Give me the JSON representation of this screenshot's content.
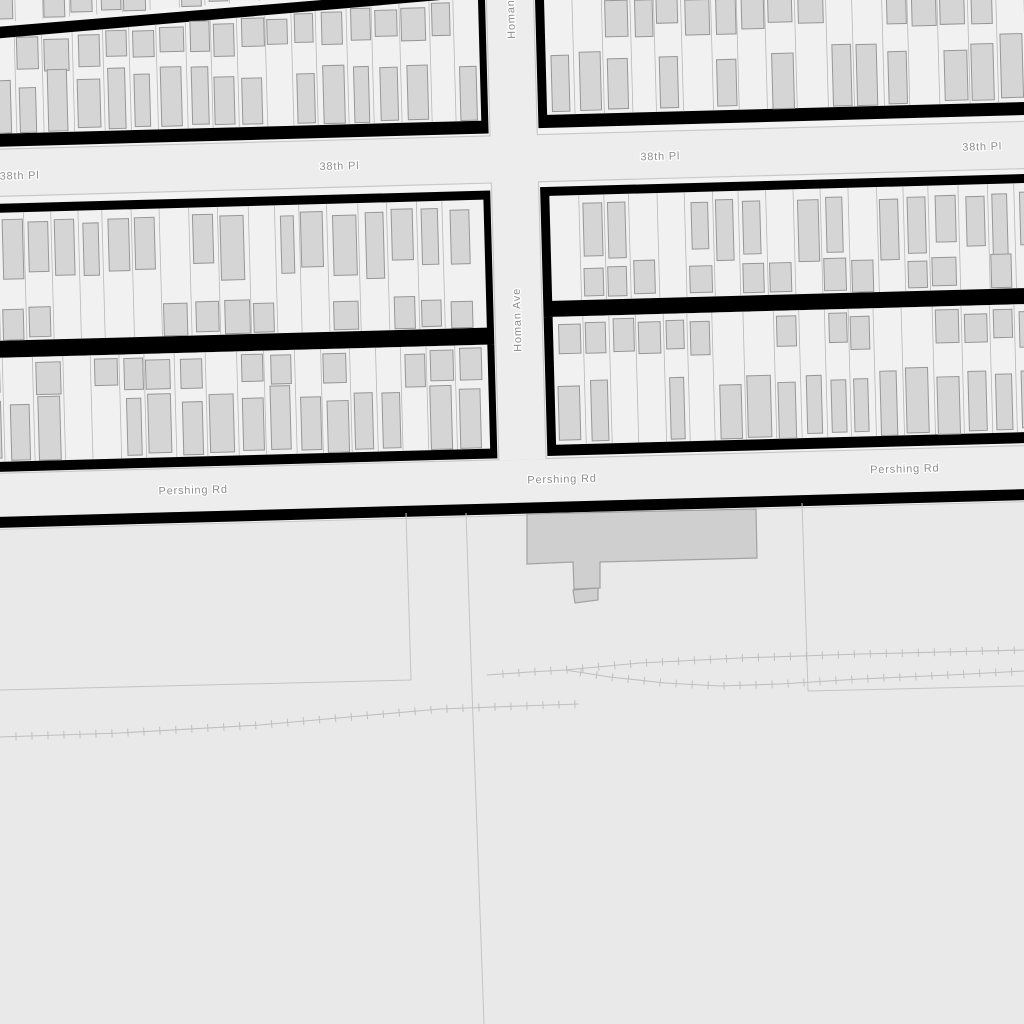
{
  "map_title": "Map: 38th Pl, Homan Ave, Pershing Rd",
  "colors": {
    "open_area": "#e9e9e9",
    "top_area": "#f3f3f3",
    "street_fill": "#ededed",
    "street_casing": "#c9c9c9",
    "block_border": "#000000",
    "parcel_fill": "#f1f1f1",
    "lot_line": "#b8b8b8",
    "building_fill": "#d5d5d5",
    "building_stroke": "#979797",
    "big_building_fill": "#cfcfcf",
    "big_building_stroke": "#a2a2a2",
    "label_color": "#8c8c8c",
    "label_halo": "#ffffff",
    "line_color": "#c4c4c4",
    "rail_color": "#bfbfbf"
  },
  "rotation_deg": -1.55,
  "rotation_center": [
    512,
    480
  ],
  "streets": [
    {
      "id": "street-38th-pl",
      "name": "38th Pl",
      "rect": [
        -120,
        136,
        1400,
        46
      ]
    },
    {
      "id": "street-pershing-rd",
      "name": "Pershing Rd",
      "rect": [
        -120,
        460,
        1400,
        43
      ]
    },
    {
      "id": "street-homan-ave",
      "name": "Homan Ave",
      "rect": [
        500,
        -120,
        46,
        580
      ]
    }
  ],
  "labels": [
    {
      "street": "street-38th-pl",
      "text": "38th Pl",
      "x": 28,
      "y": 166,
      "vertical": false
    },
    {
      "street": "street-38th-pl",
      "text": "38th Pl",
      "x": 348,
      "y": 165,
      "vertical": false
    },
    {
      "street": "street-38th-pl",
      "text": "38th Pl",
      "x": 669,
      "y": 164,
      "vertical": false
    },
    {
      "street": "street-38th-pl",
      "text": "38th Pl",
      "x": 991,
      "y": 163,
      "vertical": false
    },
    {
      "street": "street-pershing-rd",
      "text": "Pershing Rd",
      "x": 193,
      "y": 485,
      "vertical": false
    },
    {
      "street": "street-pershing-rd",
      "text": "Pershing Rd",
      "x": 562,
      "y": 484,
      "vertical": false
    },
    {
      "street": "street-pershing-rd",
      "text": "Pershing Rd",
      "x": 905,
      "y": 483,
      "vertical": false
    },
    {
      "street": "street-homan-ave",
      "text": "Homan Ave",
      "x": 525,
      "y": 352,
      "vertical": true
    },
    {
      "street": "street-homan-ave",
      "text": "Homan Ave",
      "x": 527,
      "y": 39,
      "vertical": true
    }
  ],
  "blocks": [
    {
      "id": "block-nw-sliver",
      "seed": 7,
      "lotW": 27.5,
      "parcels": {
        "x": -80,
        "w": 571,
        "poly": [
          [
            -80,
            -50
          ],
          [
            491,
            -50
          ],
          [
            491,
            -18
          ],
          [
            -80,
            14
          ]
        ],
        "y": -50,
        "botDiag": {
          "p1": [
            -80,
            14
          ],
          "p2": [
            491,
            -18
          ]
        }
      },
      "rows": [
        {
          "kind": "garage",
          "edge": "bottom",
          "hMin": 24,
          "hMax": 30,
          "prob": 0.7,
          "xMax": 300
        }
      ]
    },
    {
      "id": "block-nw",
      "seed": 21,
      "lotW": 27.5,
      "black": {
        "poly": [
          [
            -80,
            18
          ],
          [
            498,
            -14
          ],
          [
            498,
            133
          ],
          [
            -80,
            133
          ]
        ]
      },
      "parcels": {
        "x": -80,
        "w": 571,
        "poly": [
          [
            -80,
            30
          ],
          [
            491,
            -4
          ],
          [
            491,
            120
          ],
          [
            -80,
            120
          ]
        ],
        "topDiag": {
          "p1": [
            -80,
            30
          ],
          "p2": [
            491,
            -4
          ]
        },
        "y2": 120
      },
      "rows": [
        {
          "kind": "garage",
          "edge": "top",
          "hMin": 24,
          "hMax": 34,
          "prob": 0.75
        },
        {
          "kind": "house",
          "edge": "bottom",
          "y": 120,
          "hMin": 44,
          "hMax": 62,
          "prob": 0.9
        }
      ]
    },
    {
      "id": "block-ne",
      "seed": 33,
      "lotW": 27.5,
      "black": {
        "rect": [
          548,
          -80,
          560,
          209
        ]
      },
      "parcels": {
        "x": 557,
        "w": 551,
        "y": -80,
        "h": 196
      },
      "rows": [
        {
          "kind": "garage",
          "edge": "top",
          "y": 0,
          "hMin": 26,
          "hMax": 38,
          "prob": 0.78
        },
        {
          "kind": "house",
          "edge": "bottom",
          "y": 116,
          "hMin": 46,
          "hMax": 64,
          "prob": 0.85
        }
      ]
    },
    {
      "id": "block-mid-w",
      "seed": 45,
      "lotW": 27.5,
      "black": {
        "rect": [
          -80,
          190,
          578,
          154
        ]
      },
      "parcels": {
        "x": -80,
        "w": 571,
        "y": 199,
        "h": 128
      },
      "rows": [
        {
          "kind": "house",
          "edge": "top",
          "y": 206,
          "hMin": 48,
          "hMax": 66,
          "prob": 0.86
        },
        {
          "kind": "garage",
          "edge": "bottom",
          "y": 327,
          "hMin": 26,
          "hMax": 34,
          "prob": 0.6
        }
      ]
    },
    {
      "id": "block-mid-e",
      "seed": 57,
      "lotW": 27.5,
      "black": {
        "rect": [
          548,
          188,
          560,
          130
        ]
      },
      "parcels": {
        "x": 557,
        "w": 551,
        "y": 197,
        "h": 105
      },
      "rows": [
        {
          "kind": "house",
          "edge": "top",
          "y": 204,
          "hMin": 46,
          "hMax": 62,
          "prob": 0.84
        },
        {
          "kind": "garage",
          "edge": "bottom",
          "y": 302,
          "hMin": 26,
          "hMax": 34,
          "prob": 0.66
        }
      ]
    },
    {
      "id": "block-s-w",
      "seed": 69,
      "lotW": 27.5,
      "black": {
        "rect": [
          -80,
          344,
          578,
          114
        ]
      },
      "parcels": {
        "x": -80,
        "w": 571,
        "y": 344,
        "h": 104
      },
      "rows": [
        {
          "kind": "garage",
          "edge": "top",
          "y": 347,
          "hMin": 26,
          "hMax": 34,
          "prob": 0.6
        },
        {
          "kind": "house",
          "edge": "bottom",
          "y": 448,
          "hMin": 50,
          "hMax": 64,
          "prob": 0.86
        }
      ]
    },
    {
      "id": "block-s-e",
      "seed": 81,
      "lotW": 27.5,
      "black": {
        "rect": [
          548,
          318,
          560,
          139
        ]
      },
      "parcels": {
        "x": 557,
        "w": 551,
        "y": 318,
        "h": 128
      },
      "rows": [
        {
          "kind": "garage",
          "edge": "top",
          "y": 321,
          "hMin": 28,
          "hMax": 36,
          "prob": 0.7
        },
        {
          "kind": "house",
          "edge": "bottom",
          "y": 446,
          "hMin": 52,
          "hMax": 66,
          "prob": 0.86
        }
      ]
    }
  ],
  "south_border_band": [
    -80,
    503,
    1260,
    11
  ],
  "south_casing_y": 515.5,
  "yard": {
    "building_main": [
      [
        527,
        514
      ],
      [
        756,
        509
      ],
      [
        757,
        558
      ],
      [
        600,
        562
      ],
      [
        600,
        588
      ],
      [
        574,
        589
      ],
      [
        573,
        562
      ],
      [
        527,
        564
      ]
    ],
    "building_small": [
      [
        573,
        590
      ],
      [
        598,
        588
      ],
      [
        598,
        600
      ],
      [
        575,
        603
      ]
    ],
    "property_lines": [
      [
        [
          0,
          690
        ],
        [
          411,
          680
        ],
        [
          406,
          513
        ]
      ],
      [
        [
          466,
          513
        ],
        [
          472,
          690
        ],
        [
          484,
          1024
        ]
      ],
      [
        [
          802,
          503
        ],
        [
          808,
          691
        ],
        [
          1024,
          686
        ]
      ]
    ],
    "railways": [
      [
        [
          0,
          737
        ],
        [
          120,
          733
        ],
        [
          260,
          725
        ],
        [
          360,
          716
        ],
        [
          440,
          709
        ],
        [
          520,
          706
        ],
        [
          579,
          704
        ]
      ],
      [
        [
          487,
          675
        ],
        [
          530,
          672
        ],
        [
          565,
          670
        ],
        [
          640,
          663
        ],
        [
          740,
          658
        ],
        [
          860,
          654
        ],
        [
          1024,
          650
        ]
      ],
      [
        [
          565,
          670
        ],
        [
          610,
          677
        ],
        [
          665,
          683
        ],
        [
          720,
          686
        ],
        [
          780,
          684
        ],
        [
          860,
          679
        ],
        [
          950,
          675
        ],
        [
          1024,
          671
        ]
      ]
    ],
    "tick_step": 16,
    "tick_half": 4
  }
}
